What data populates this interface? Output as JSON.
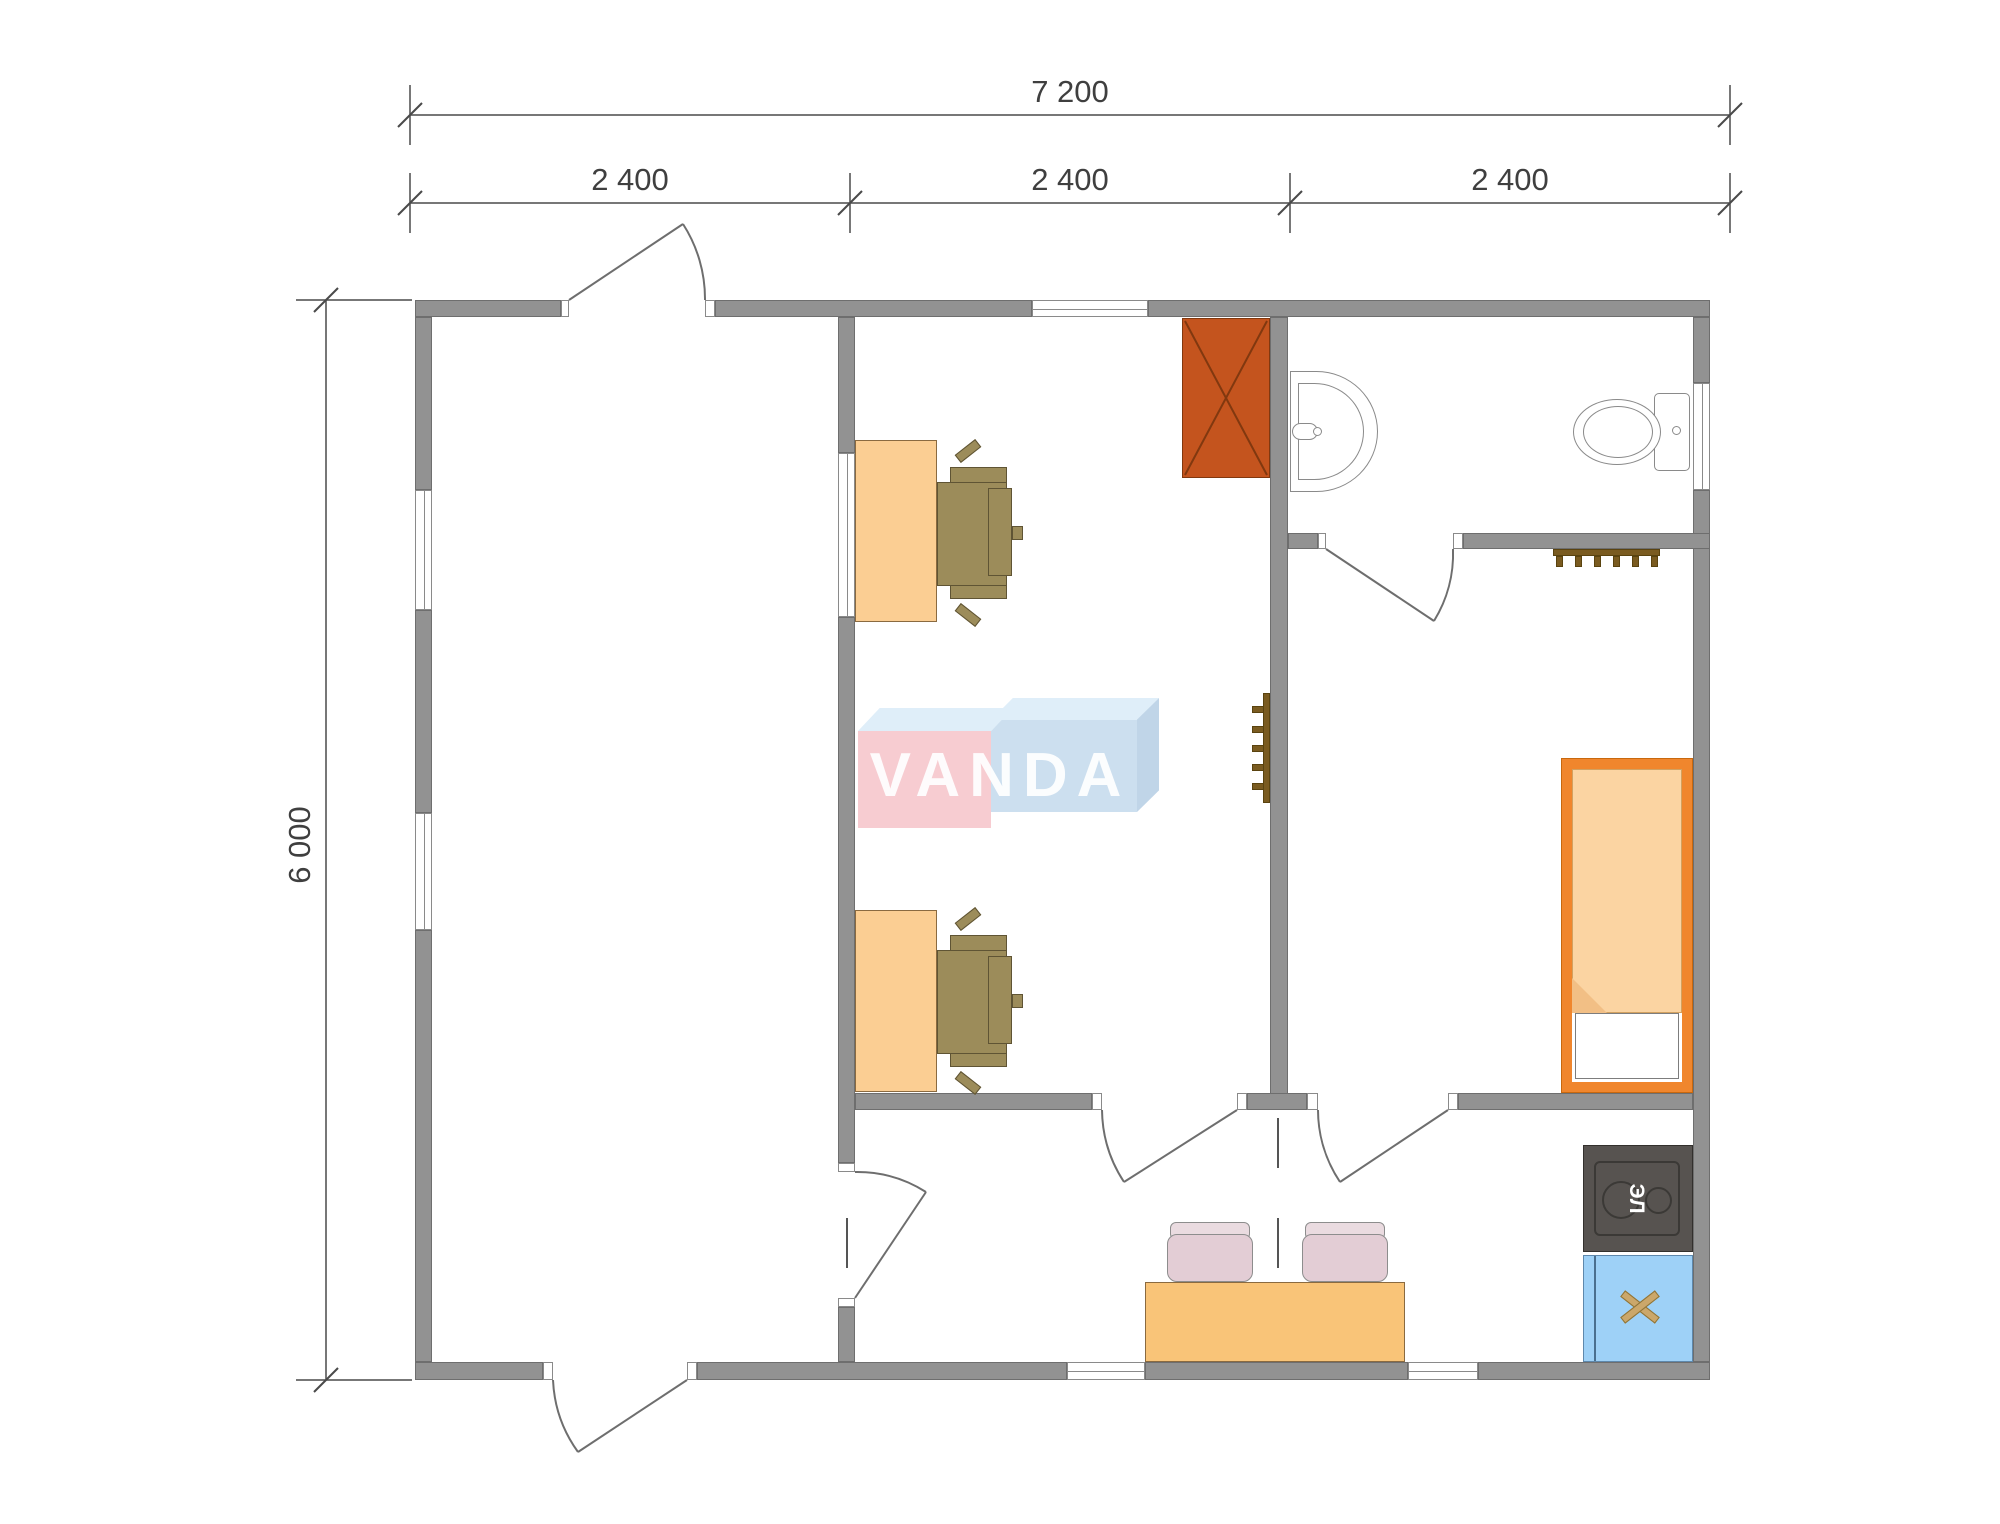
{
  "watermark": {
    "brand": "VANDA"
  },
  "dimensions": {
    "overall_width_mm": "7 200",
    "segments_mm": [
      "2 400",
      "2 400",
      "2 400"
    ],
    "overall_height_mm": "6 000"
  },
  "appliances": {
    "electric_stove_label": "ЭЛ"
  },
  "furniture_icons": [
    "wardrobe-icon",
    "office-desk-icon",
    "office-chair-icon",
    "washbasin-icon",
    "toilet-icon",
    "radiator-icon",
    "single-bed-icon",
    "dining-table-icon",
    "dining-chair-icon",
    "electric-stove-icon",
    "kitchen-sink-icon",
    "door-swing-icon",
    "window-icon"
  ],
  "colors": {
    "wall": "#929292",
    "wall_edge": "#6E6E6E",
    "line": "#6A6A6A",
    "dim": "#3F3F3F",
    "wardrobe": "#C4541E",
    "wardrobe_line": "#81380F",
    "desk": "#FBCE93",
    "furniture_line": "#8A6A40",
    "chair": "#9C8C5A",
    "chair_line": "#5F5434",
    "table": "#F9C478",
    "dining_chair": "#E3CDD5",
    "dining_chair_back": "#EADBE0",
    "bed_frame": "#F0862D",
    "bed_frame_line": "#C8680E",
    "blanket": "#FBD4A2",
    "blanket_line": "#D2A160",
    "stove": "#575350",
    "stove_line": "#3B3936",
    "sink_cabinet": "#9ED1F7",
    "sink_cabinet_line": "#5E88AC",
    "sink_x": "#CBA76A",
    "radiator": "#7A5B20",
    "logo_pink": "#F6C2C8",
    "logo_blue": "#C2D9EC",
    "logo_blue_light": "#D9EBF8",
    "logo_text": "#FFFFFF",
    "fixture_line": "#8A8A8A"
  }
}
